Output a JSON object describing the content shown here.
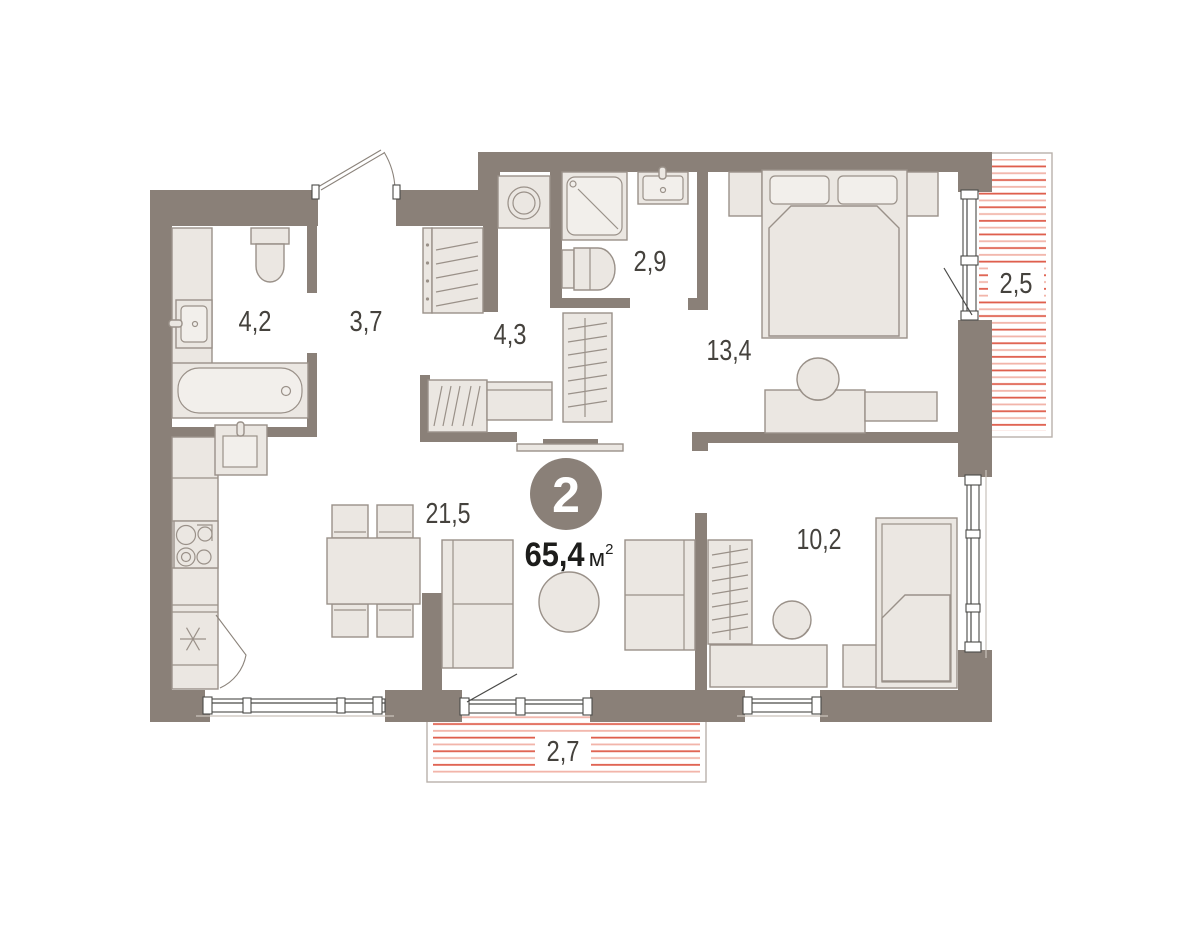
{
  "plan": {
    "title": "apartment-floor-plan",
    "badge": {
      "room_count": "2"
    },
    "area": {
      "value": "65,4",
      "unit": "м",
      "superscript": "2"
    }
  },
  "rooms": [
    {
      "name": "bathroom",
      "area_label": "4,2"
    },
    {
      "name": "hallway",
      "area_label": "3,7"
    },
    {
      "name": "wardrobe-room",
      "area_label": "4,3"
    },
    {
      "name": "shower-room",
      "area_label": "2,9"
    },
    {
      "name": "bedroom-main",
      "area_label": "13,4"
    },
    {
      "name": "living-kitchen",
      "area_label": "21,5"
    },
    {
      "name": "bedroom-second",
      "area_label": "10,2"
    },
    {
      "name": "loggia-right",
      "area_label": "2,5"
    },
    {
      "name": "loggia-bottom",
      "area_label": "2,7"
    }
  ],
  "colors": {
    "wall": "#8A8078",
    "furniture_fill": "#EBE7E2",
    "furniture_stroke": "#9A9189",
    "hatch_strong": "#DF5F4D",
    "hatch_light": "#F2B5AA",
    "label_text": "#45423D",
    "area_text": "#1D1D1B",
    "badge_fill": "#8A8078",
    "badge_text": "#FFFFFF"
  }
}
